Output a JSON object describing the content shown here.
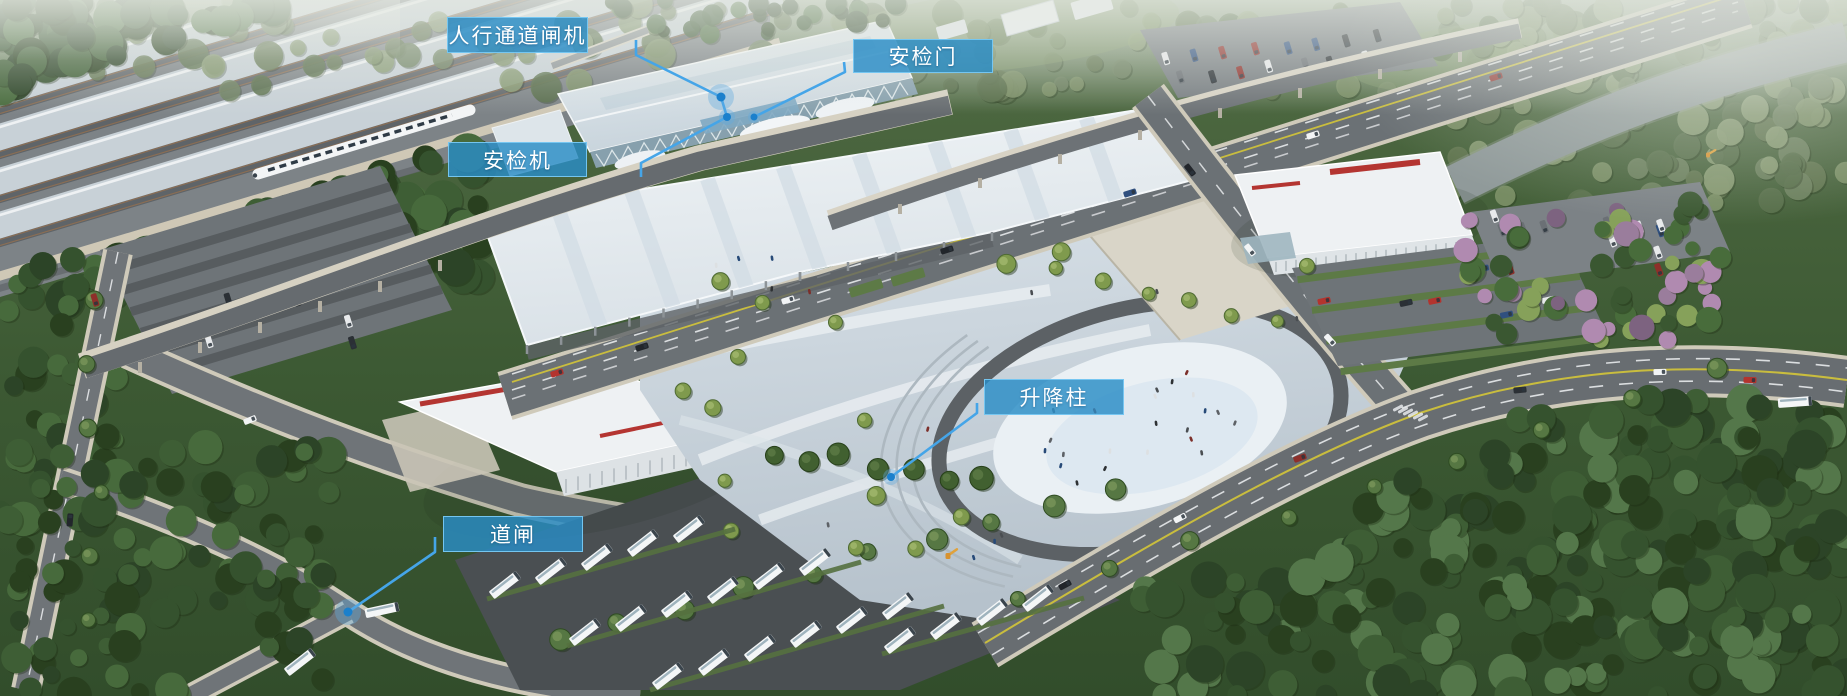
{
  "annotations": {
    "labels": [
      {
        "id": "pedestrian-gate",
        "text": "人行通道闸机",
        "x": 447,
        "y": 17,
        "w": 141,
        "h": 36
      },
      {
        "id": "security-door",
        "text": "安检门",
        "x": 853,
        "y": 39,
        "w": 140,
        "h": 34
      },
      {
        "id": "security-scanner",
        "text": "安检机",
        "x": 448,
        "y": 142,
        "w": 139,
        "h": 35
      },
      {
        "id": "bollard",
        "text": "升降柱",
        "x": 984,
        "y": 379,
        "w": 140,
        "h": 36
      },
      {
        "id": "road-barrier",
        "text": "道闸",
        "x": 443,
        "y": 516,
        "w": 140,
        "h": 36
      }
    ],
    "leader_lines": [
      {
        "id": "line-pedestrian-gate-and-scanner",
        "points": [
          [
            636,
            40
          ],
          [
            636,
            55
          ],
          [
            721,
            97
          ],
          [
            727,
            117
          ],
          [
            641,
            163
          ],
          [
            641,
            177
          ]
        ]
      },
      {
        "id": "line-security-door",
        "points": [
          [
            844,
            62
          ],
          [
            845,
            72
          ],
          [
            754,
            117
          ]
        ]
      },
      {
        "id": "line-bollard",
        "points": [
          [
            977,
            403
          ],
          [
            977,
            413
          ],
          [
            891,
            477
          ]
        ]
      },
      {
        "id": "line-road-barrier",
        "points": [
          [
            435,
            537
          ],
          [
            435,
            552
          ],
          [
            348,
            612
          ]
        ]
      }
    ],
    "dots": [
      {
        "id": "dot-pedestrian-gate",
        "x": 721,
        "y": 97,
        "core": 4.5,
        "halo": 13
      },
      {
        "id": "dot-security-scanner",
        "x": 727,
        "y": 117,
        "core": 4,
        "halo": 8
      },
      {
        "id": "dot-security-door",
        "x": 754,
        "y": 117,
        "core": 3.5,
        "halo": 6
      },
      {
        "id": "dot-bollard",
        "x": 891,
        "y": 477,
        "core": 4,
        "halo": 8
      },
      {
        "id": "dot-road-barrier",
        "x": 348,
        "y": 612,
        "core": 4.5,
        "halo": 13
      }
    ],
    "colors": {
      "label_fill": "rgba(42,140,198,0.82)",
      "label_border": "rgba(120,200,242,0.95)",
      "label_text": "#ffffff",
      "leader_line": "#45a5e8",
      "dot_core": "#1b80cc",
      "dot_halo": "rgba(98,170,224,0.38)"
    }
  }
}
